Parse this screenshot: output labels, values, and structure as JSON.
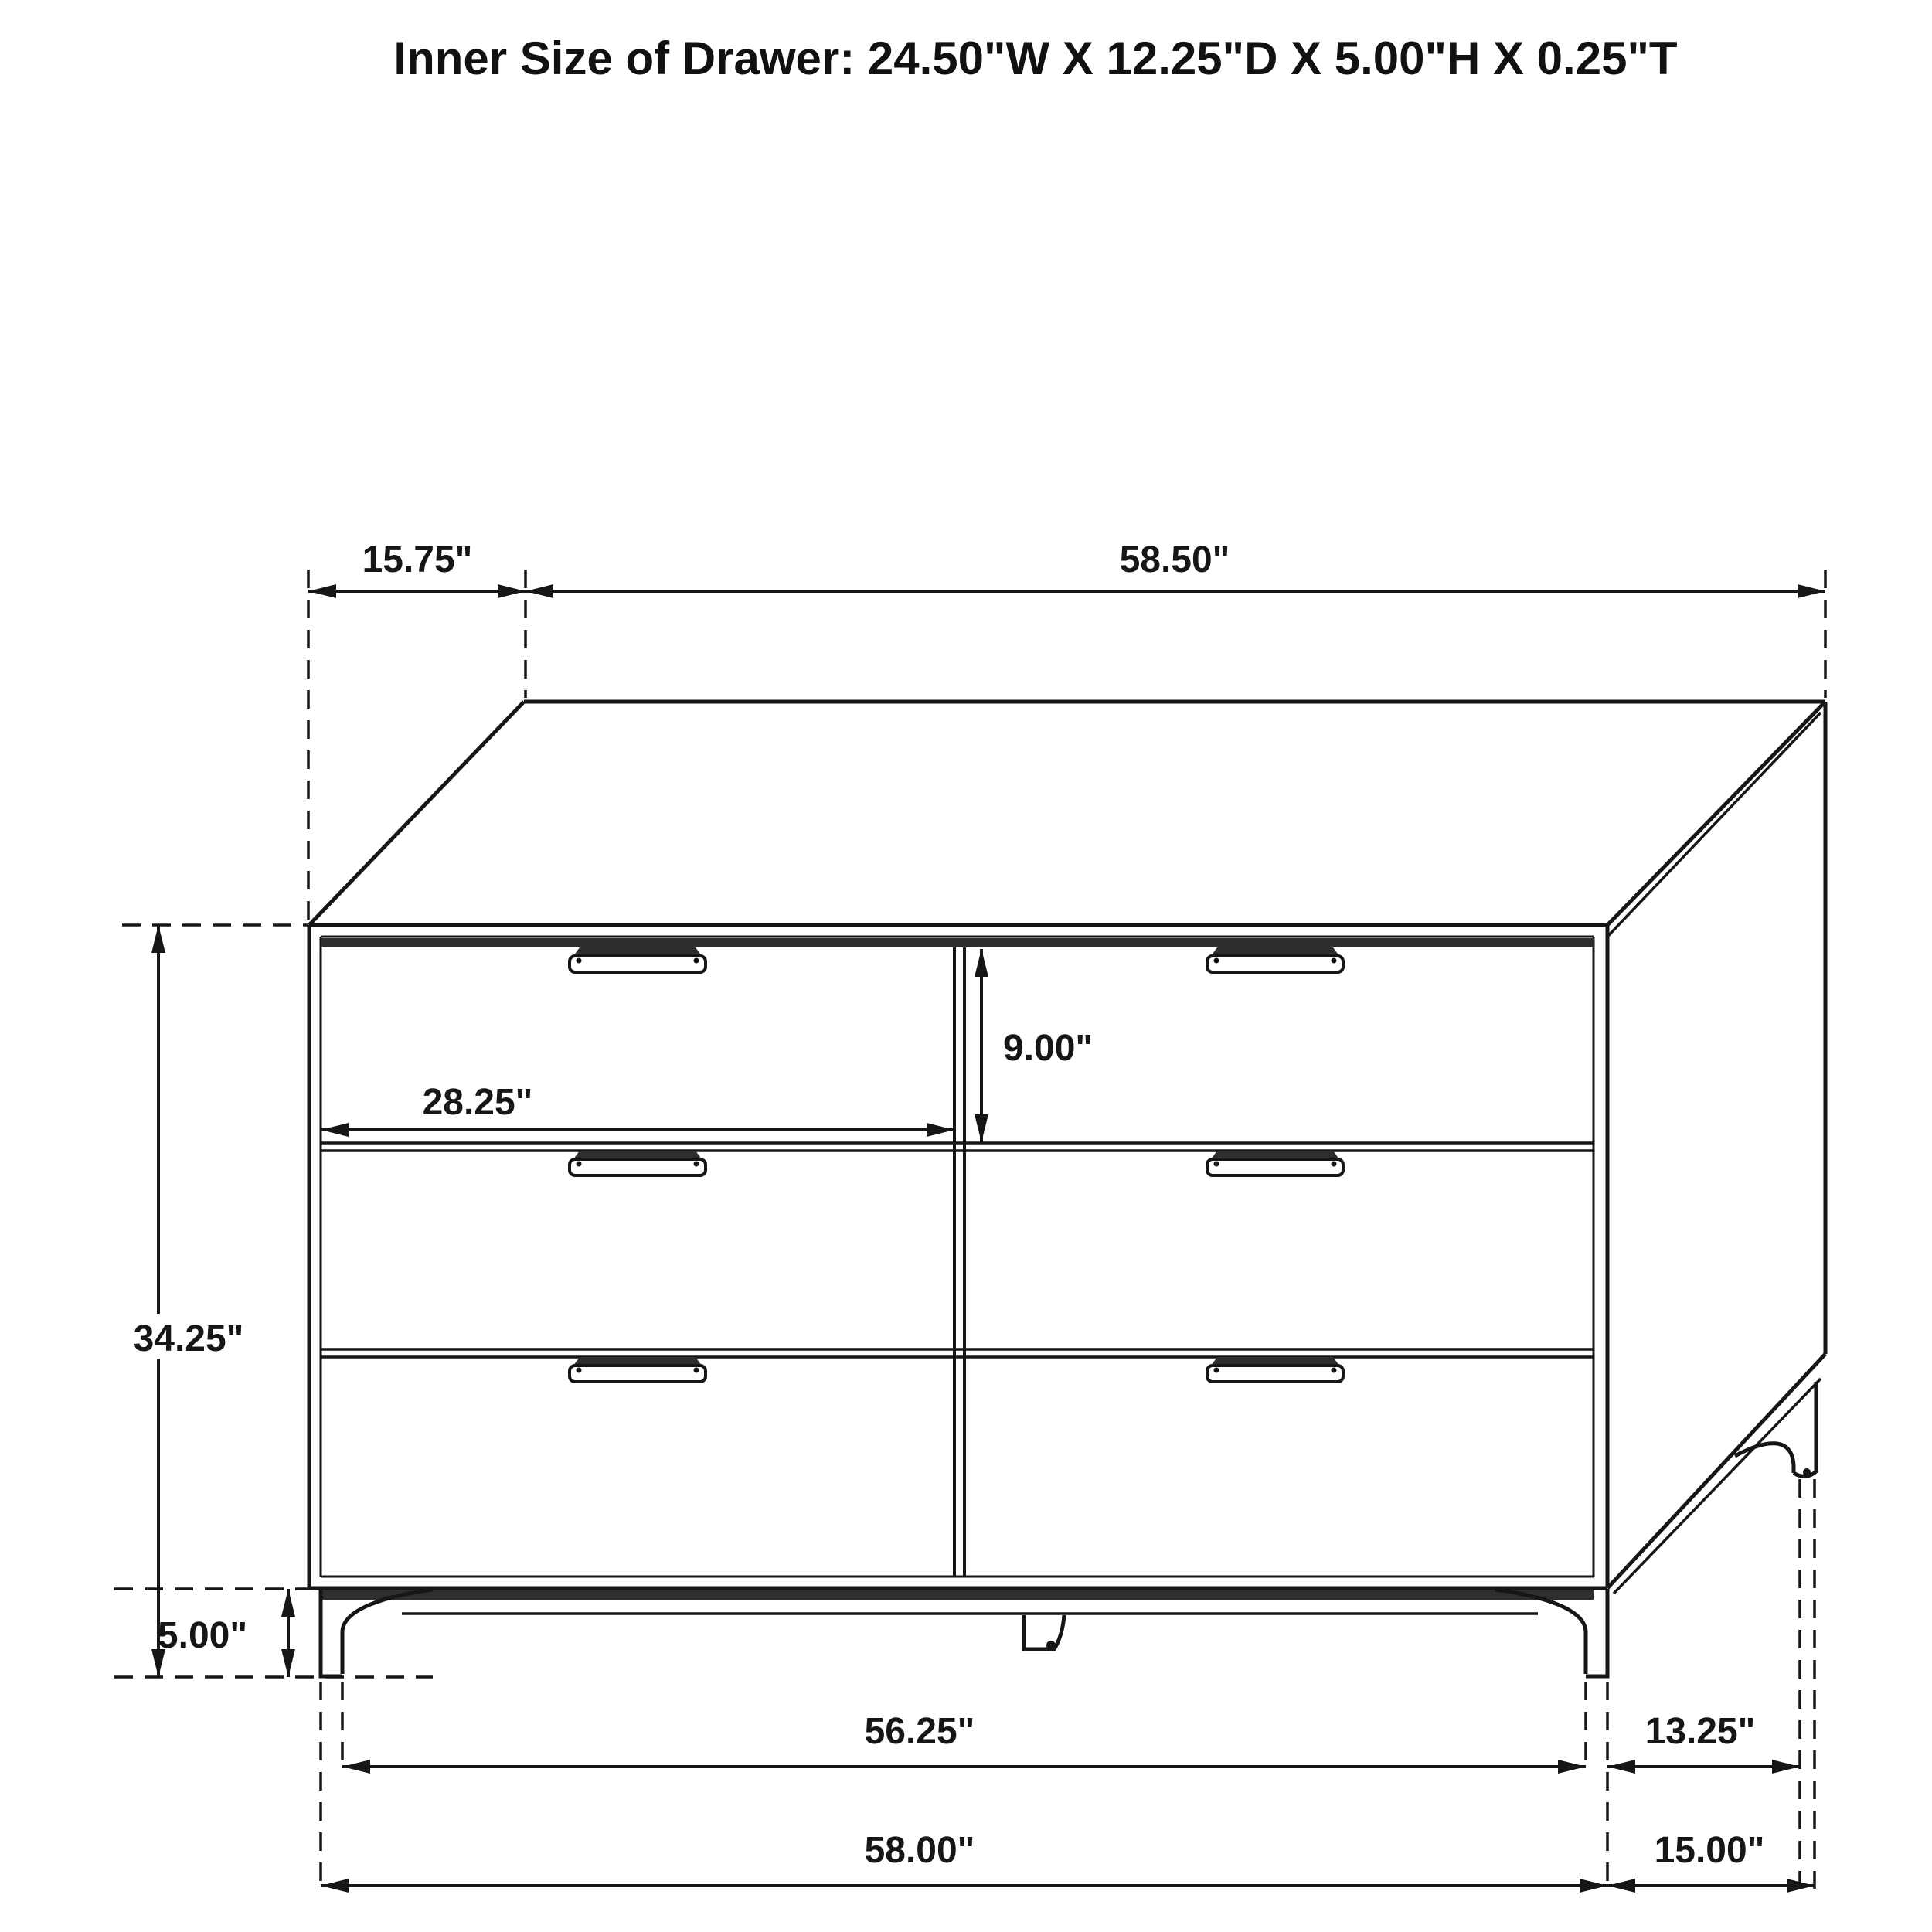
{
  "title": "Inner Size of Drawer: 24.50\"W X 12.25\"D X 5.00\"H X 0.25\"T",
  "colors": {
    "line": "#161616",
    "background": "#ffffff",
    "groove_shadow": "#2e2e2e"
  },
  "dresser": {
    "type": "six-drawer-dresser",
    "drawer_rows": 3,
    "drawer_columns": 2
  },
  "dimensions": {
    "top_depth": {
      "label": "15.75\""
    },
    "top_width": {
      "label": "58.50\""
    },
    "overall_height": {
      "label": "34.25\""
    },
    "leg_height": {
      "label": "5.00\""
    },
    "drawer_width": {
      "label": "28.25\""
    },
    "drawer_front_height": {
      "label": "9.00\""
    },
    "feet_span": {
      "label": "56.25\""
    },
    "side_feet_depth": {
      "label": "13.25\""
    },
    "base_width": {
      "label": "58.00\""
    },
    "side_depth": {
      "label": "15.00\""
    }
  }
}
